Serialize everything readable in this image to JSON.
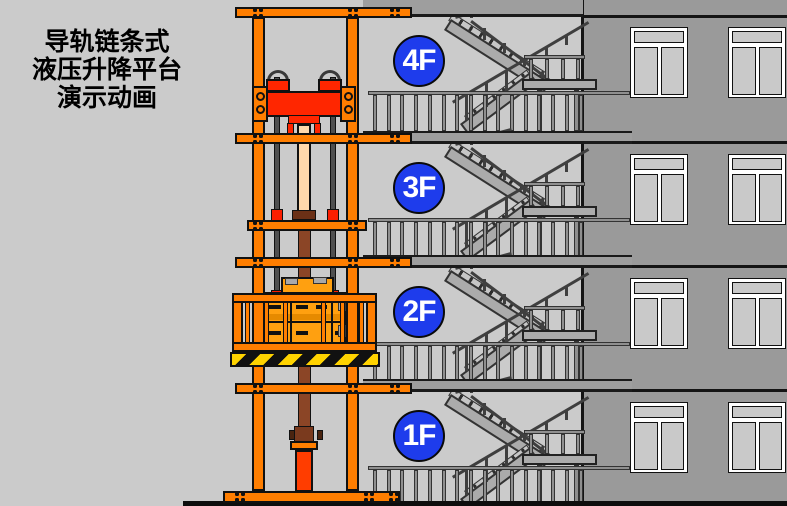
{
  "title": {
    "lines": [
      "导轨链条式",
      "液压升降平台",
      "演示动画"
    ]
  },
  "floors": [
    {
      "label": "4F"
    },
    {
      "label": "3F"
    },
    {
      "label": "2F"
    },
    {
      "label": "1F"
    }
  ],
  "colors": {
    "frame_orange": "#FF7E00",
    "carriage_red": "#FF2600",
    "cylinder_red": "#FF3D00",
    "barrel_brown": "#8B4526",
    "rod_tan": "#FFD9AC",
    "cargo_amber": "#FFA010",
    "floor_badge_blue": "#1E3CEC",
    "hazard_yellow": "#FFD300",
    "wall_gray": "#9A9A9A",
    "background_gray": "#CBCBCB"
  }
}
